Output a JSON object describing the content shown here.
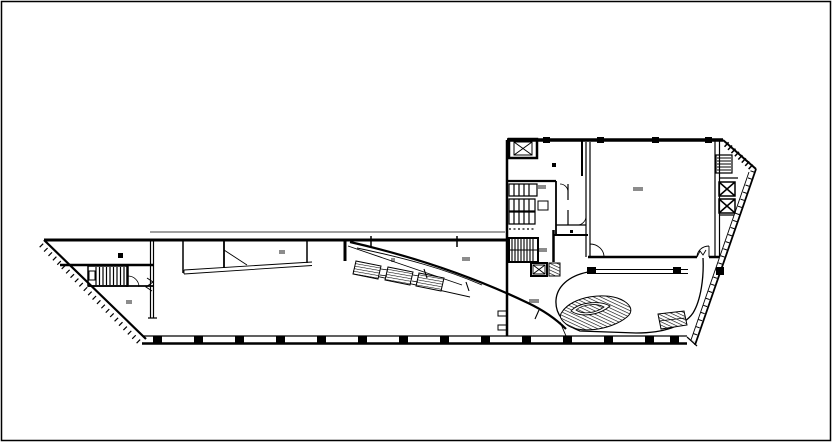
{
  "meta": {
    "description": "black-and-white CAD architectural floor plan, long tapered west wing joined to a rectangular east block with large hall, cores, curved lobby and hatched stairs",
    "canvas_width": 832,
    "canvas_height": 442,
    "background_color": "#ffffff",
    "line_color": "#000000",
    "viewbox": "0 0 832 442"
  },
  "drawing": {
    "paths": [
      {
        "name": "frame-border",
        "d": "M1.5,1.5 H830.5 V440.5 H1.5 Z",
        "w": 1.5
      },
      {
        "name": "wing-top-wall",
        "d": "M44,240 H508",
        "w": 3
      },
      {
        "name": "wing-top-parallel-line",
        "d": "M150,232 H505",
        "w": 0.8
      },
      {
        "name": "wing-left-diagonal-edge",
        "d": "M44,240 L146,339",
        "w": 2.2
      },
      {
        "name": "wing-diagonal-hatch-ticks",
        "d": "M41,245 L140,343",
        "w": 5,
        "dash": "1.2 5"
      },
      {
        "name": "bottom-wall-upper-line",
        "d": "M143,336 H687",
        "w": 1.2
      },
      {
        "name": "bottom-wall-lower-line",
        "d": "M142,343.5 H687",
        "w": 2.6
      },
      {
        "name": "wing-vertical-wall",
        "d": "M150.5,240 V318 M153.5,240 V318 M148,318 H157",
        "w": 1.2
      },
      {
        "name": "wall-break-symbol",
        "d": "M147,278 L153,282 L146,287 L152,291",
        "w": 1
      },
      {
        "name": "partition-a",
        "d": "M183,240 V273",
        "w": 1.5
      },
      {
        "name": "partition-b",
        "d": "M224,240 V268",
        "w": 1.8
      },
      {
        "name": "partition-c",
        "d": "M307,240 V263",
        "w": 1.5
      },
      {
        "name": "partition-d",
        "d": "M345,240 V261",
        "w": 3
      },
      {
        "name": "door-leaf-line",
        "d": "M224,250 L247,265",
        "w": 0.9
      },
      {
        "name": "wedge-sliver",
        "d": "M184,270 L312,262 M184,274 L312,265.5 M184,270 V274",
        "w": 0.9
      },
      {
        "name": "tip-room-wall-upper",
        "d": "M60,265 H153",
        "w": 2.5
      },
      {
        "name": "tip-room-wall-lower",
        "d": "M88,286 H153",
        "w": 1.8
      },
      {
        "name": "tip-partition",
        "d": "M127,265 V287",
        "w": 1.5
      },
      {
        "name": "tip-door-arc",
        "d": "M128,276 A11,11 0 0 1 139,287",
        "w": 0.8
      },
      {
        "name": "stair-west-outline",
        "d": "M88,266 H128 V286 H88 Z",
        "w": 1.5
      },
      {
        "name": "stair-west-treads",
        "d": "M96,267 V285 M99.5,267 V285 M103,267 V285 M106.5,267 V285 M110,267 V285 M113.5,267 V285 M117,267 V285 M120.5,267 V285 M124,267 V285",
        "w": 1.2
      },
      {
        "name": "stair-west-landing",
        "d": "M89,271 H95 V280 H89 Z",
        "w": 1
      },
      {
        "name": "ramp-edge-upper",
        "d": "M348,246 L462,285",
        "w": 0.9
      },
      {
        "name": "ramp-edge-lower",
        "d": "M353,271 L470,297",
        "w": 0.9
      },
      {
        "name": "escalator-1",
        "d": "M356,261 L381,266 L378,279 L353,274 Z",
        "w": 1,
        "fill": "hatch2"
      },
      {
        "name": "escalator-2",
        "d": "M388,267 L413,272 L410,285 L385,280 Z",
        "w": 1,
        "fill": "hatch2"
      },
      {
        "name": "escalator-3",
        "d": "M419,273 L444,278 L441,291 L416,286 Z",
        "w": 1,
        "fill": "hatch2"
      },
      {
        "name": "escalator-connectors",
        "d": "M381,269 L388,270 M380,275 L387,276 M413,275 L419,276 M412,281 L418,282",
        "w": 0.8
      },
      {
        "name": "atrium-sweep-wall",
        "d": "M350,242 C420,258 478,279 528,303 C545,311 557,320 566,329",
        "w": 2.2
      },
      {
        "name": "atrium-sweep-inner-line",
        "d": "M357,248 C405,258 445,269 482,285",
        "w": 0.9
      },
      {
        "name": "sweep-tick-marks",
        "d": "M424,269 L427,278 M466,282 L469,291 M539,310 L535,319",
        "w": 1.1
      },
      {
        "name": "mullion-tick-a",
        "d": "M371,236 V248",
        "w": 1.5
      },
      {
        "name": "mullion-tick-b",
        "d": "M457,236 V247",
        "w": 1.5
      },
      {
        "name": "junction-line",
        "d": "M560,322 L566,336",
        "w": 0.9
      },
      {
        "name": "block-top-wall",
        "d": "M507,140 H723",
        "w": 3.5
      },
      {
        "name": "block-left-wall",
        "d": "M507,140 V336",
        "w": 2.5
      },
      {
        "name": "corner-diagonal",
        "d": "M723,140 L756,169",
        "w": 2
      },
      {
        "name": "corner-hatch-band",
        "d": "M726,144 L753,169",
        "w": 6,
        "dash": "1.5 3.2"
      },
      {
        "name": "facade-outer-line",
        "d": "M756,169 L695,345",
        "w": 1.8
      },
      {
        "name": "facade-inner-line",
        "d": "M749,172 L691,340",
        "w": 0.9
      },
      {
        "name": "facade-hatch-ticks",
        "d": "M752.5,171 L693,341",
        "w": 4,
        "dash": "1 6.5"
      },
      {
        "name": "facade-tail",
        "d": "M687,337 L697,346",
        "w": 1.2
      },
      {
        "name": "hall-left-wall",
        "d": "M586,142 V257 M590,142 V257",
        "w": 1.2
      },
      {
        "name": "hall-right-wall",
        "d": "M715,140 V257 M719.5,140 V257",
        "w": 1.2
      },
      {
        "name": "hall-bottom-wall",
        "d": "M588,257 H697 M709,257 H719",
        "w": 2.5
      },
      {
        "name": "hall-door-left",
        "d": "M590,257 V244 M590,244 A14,13 0 0 1 604,257",
        "w": 0.9
      },
      {
        "name": "hall-door-right",
        "d": "M709,257 V246 M697,257 A12,11 0 0 1 709,246 M697,257 L700,251 L703,255 L706,250",
        "w": 0.9
      },
      {
        "name": "elevator-nw-shaft",
        "d": "M509,139 H537 V158 H509 Z",
        "w": 2.5
      },
      {
        "name": "elevator-nw-car",
        "d": "M514,142 H532 V155 H514 Z M514,142 L532,155 M532,142 L514,155",
        "w": 1
      },
      {
        "name": "service-wall-h180",
        "d": "M507,181 H556",
        "w": 2.2
      },
      {
        "name": "service-wall-x582",
        "d": "M582,141 V176",
        "w": 2
      },
      {
        "name": "service-wall-x556",
        "d": "M556,181 V235",
        "w": 1.8
      },
      {
        "name": "service-wall-h235",
        "d": "M553,235 H588",
        "w": 2
      },
      {
        "name": "service-wall-x553",
        "d": "M553.5,230 V262",
        "w": 2.5
      },
      {
        "name": "wc-row-a",
        "d": "M509,184 H537 V196 H509 Z M514,184 V196 M519,184 V196 M524,184 V196 M529,184 V196",
        "w": 1.2
      },
      {
        "name": "wc-row-b",
        "d": "M509,199 H535 V211 H509 Z M514,199 V211 M519,199 V211 M524,199 V211 M529,199 V211",
        "w": 1.2
      },
      {
        "name": "wc-row-c",
        "d": "M509,212 H535 V224 H509 Z M514,212 V224 M519,212 V224 M524,212 V224 M529,212 V224",
        "w": 1.2
      },
      {
        "name": "wc-fixture-box",
        "d": "M538,201 H548 V210 H538 Z",
        "w": 1
      },
      {
        "name": "dotted-partition",
        "d": "M509,229 H535",
        "w": 1.2,
        "dash": "2 2.5"
      },
      {
        "name": "stair-core-outline",
        "d": "M509,238 H538 V262 H509 Z",
        "w": 2
      },
      {
        "name": "stair-core-treads",
        "d": "M512,239 V261 M515,239 V261 M518,239 V261 M521,239 V261 M524,239 V261 M527,239 V261 M530,239 V261 M533,239 V261",
        "w": 1.1
      },
      {
        "name": "stair-core-landing",
        "d": "M509,250 H538",
        "w": 1
      },
      {
        "name": "elevator-s-shaft",
        "d": "M531,263 H547 V276 H531 Z",
        "w": 2
      },
      {
        "name": "elevator-s-car",
        "d": "M533,265 H545 V274 H533 Z M533,265 L545,274 M545,265 L533,274",
        "w": 0.9
      },
      {
        "name": "hatched-duct",
        "d": "M549,263 H560 V276 H549 Z",
        "w": 1,
        "fill": "hatch"
      },
      {
        "name": "service-wall-h262",
        "d": "M507,262 H531",
        "w": 2
      },
      {
        "name": "inner-room-walls",
        "d": "M556,225 H586 M568,184 V200 M568,210 V225",
        "w": 1.2
      },
      {
        "name": "inner-door-arc-a",
        "d": "M560,184 A8,8 0 0 1 568,192",
        "w": 0.8
      },
      {
        "name": "inner-door-arc-b",
        "d": "M578,225 A9,9 0 0 0 586,217",
        "w": 0.8
      },
      {
        "name": "stair-east-outline",
        "d": "M716,155 H732 V173 H716 Z",
        "w": 1.2
      },
      {
        "name": "stair-east-treads",
        "d": "M717,158 H731 M717,161 H731 M717,164 H731 M717,167 H731 M717,170 H731",
        "w": 1
      },
      {
        "name": "elevator-e1",
        "d": "M719,182 H735 V196 H719 Z M719,182 L735,196 M735,182 L719,196",
        "w": 1.5
      },
      {
        "name": "elevator-e2",
        "d": "M719,199 H735 V213 H719 Z M719,199 L735,213 M735,199 L719,213",
        "w": 1.5
      },
      {
        "name": "east-room-walls",
        "d": "M719,178 H738 M719,215 H734",
        "w": 1.2
      },
      {
        "name": "bridge-band",
        "d": "M588,269.5 H688 M588,273.5 H688",
        "w": 1.1
      },
      {
        "name": "lobby-curve",
        "d": "M588,272 C568,276 557,287 556,300 C555,314 564,325 580,331 L636,333 C664,333 684,326 693,313 C701,300 704,277 703,258",
        "w": 1.3
      },
      {
        "name": "curved-stair-outer",
        "d": "M562,312 C572,296 608,291 624,301 C632,306 633,312 627,317 C610,331 577,334 566,324 C560,319 559,316 562,312 Z",
        "w": 1,
        "fill": "hatch"
      },
      {
        "name": "curved-stair-band",
        "d": "M571,311 C579,302 600,300 610,306 C600,315 581,318 571,311 Z",
        "w": 0.9,
        "fill": "white"
      },
      {
        "name": "curved-stair-core",
        "d": "M576,310 C583,304 597,303 604,307 C596,313 583,315 576,310 Z",
        "w": 0.8,
        "fill": "hatch"
      },
      {
        "name": "ramp-quad",
        "d": "M658,314 L684,311 L687,325 L661,329 Z",
        "w": 1,
        "fill": "hatch"
      },
      {
        "name": "ramp-quad-midline",
        "d": "M659,321 L685,318",
        "w": 0.7
      },
      {
        "name": "door-stub-a",
        "d": "M498,311 H507 V316 H498 Z",
        "w": 1
      },
      {
        "name": "door-stub-b",
        "d": "M498,325 H507 V330 H498 Z",
        "w": 1
      }
    ],
    "squares": [
      {
        "name": "column-mark",
        "x": 153,
        "y": 336,
        "w": 9,
        "h": 8
      },
      {
        "name": "column-mark",
        "x": 194,
        "y": 336,
        "w": 9,
        "h": 8
      },
      {
        "name": "column-mark",
        "x": 235,
        "y": 336,
        "w": 9,
        "h": 8
      },
      {
        "name": "column-mark",
        "x": 276,
        "y": 336,
        "w": 9,
        "h": 8
      },
      {
        "name": "column-mark",
        "x": 317,
        "y": 336,
        "w": 9,
        "h": 8
      },
      {
        "name": "column-mark",
        "x": 358,
        "y": 336,
        "w": 9,
        "h": 8
      },
      {
        "name": "column-mark",
        "x": 399,
        "y": 336,
        "w": 9,
        "h": 8
      },
      {
        "name": "column-mark",
        "x": 440,
        "y": 336,
        "w": 9,
        "h": 8
      },
      {
        "name": "column-mark",
        "x": 481,
        "y": 336,
        "w": 9,
        "h": 8
      },
      {
        "name": "column-mark",
        "x": 522,
        "y": 336,
        "w": 9,
        "h": 8
      },
      {
        "name": "column-mark",
        "x": 563,
        "y": 336,
        "w": 9,
        "h": 8
      },
      {
        "name": "column-mark",
        "x": 604,
        "y": 336,
        "w": 9,
        "h": 8
      },
      {
        "name": "column-mark",
        "x": 645,
        "y": 336,
        "w": 9,
        "h": 8
      },
      {
        "name": "column-mark",
        "x": 670,
        "y": 336,
        "w": 9,
        "h": 8
      },
      {
        "name": "column-mark",
        "x": 543,
        "y": 137,
        "w": 7,
        "h": 6
      },
      {
        "name": "column-mark",
        "x": 597,
        "y": 137,
        "w": 7,
        "h": 6
      },
      {
        "name": "column-mark",
        "x": 652,
        "y": 137,
        "w": 7,
        "h": 6
      },
      {
        "name": "column-mark",
        "x": 705,
        "y": 137,
        "w": 7,
        "h": 6
      },
      {
        "name": "column-mark",
        "x": 587,
        "y": 267,
        "w": 9,
        "h": 7
      },
      {
        "name": "column-mark",
        "x": 673,
        "y": 267,
        "w": 8,
        "h": 7
      },
      {
        "name": "column-mark",
        "x": 716,
        "y": 267,
        "w": 8,
        "h": 8
      },
      {
        "name": "small-square-mark",
        "x": 118,
        "y": 253,
        "w": 5,
        "h": 5
      },
      {
        "name": "small-square-mark",
        "x": 552,
        "y": 163,
        "w": 4,
        "h": 4
      },
      {
        "name": "small-square-mark",
        "x": 570,
        "y": 230,
        "w": 3,
        "h": 3
      }
    ],
    "combs": [
      {
        "name": "annotation-mark",
        "x": 634,
        "y": 187,
        "n": 5
      },
      {
        "name": "annotation-mark",
        "x": 539,
        "y": 185,
        "n": 4
      },
      {
        "name": "annotation-mark",
        "x": 540,
        "y": 248,
        "n": 4
      },
      {
        "name": "annotation-mark",
        "x": 530,
        "y": 299,
        "n": 5
      },
      {
        "name": "annotation-mark",
        "x": 280,
        "y": 250,
        "n": 3
      },
      {
        "name": "annotation-mark",
        "x": 463,
        "y": 257,
        "n": 4
      },
      {
        "name": "annotation-mark",
        "x": 392,
        "y": 258,
        "n": 2
      },
      {
        "name": "annotation-mark",
        "x": 127,
        "y": 300,
        "n": 3
      }
    ]
  }
}
